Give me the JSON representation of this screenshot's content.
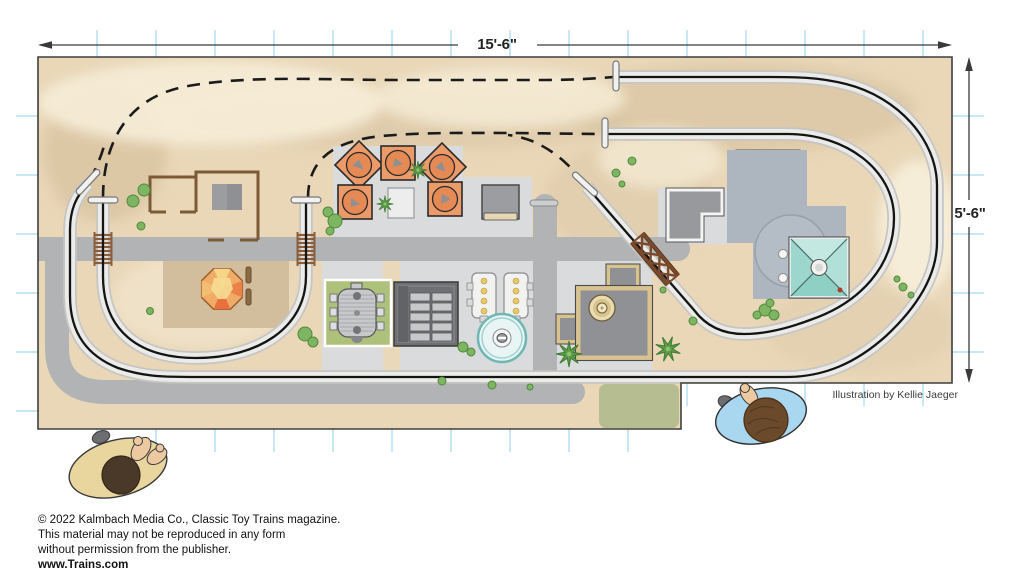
{
  "figure": {
    "title": "toy-train-layout-track-plan",
    "credit": "Illustration by Kellie Jaeger",
    "dimensions": {
      "width_label": "15'-6\"",
      "height_label": "5'-6\""
    },
    "copyright": {
      "line1": "© 2022 Kalmbach Media Co., Classic Toy Trains magazine.",
      "line2": "This material may not be reproduced in any form",
      "line3": "without permission from the publisher.",
      "line4": "www.Trains.com"
    },
    "colors": {
      "board_base": "#e9d7b8",
      "terrain_light": "#f6ecd6",
      "terrain_dark": "#d8c4a1",
      "road": "#b2b3b5",
      "plaza": "#dadbdc",
      "platform_blue_gray": "#adb6be",
      "track_rail": "#141414",
      "track_bed": "#ebebe9",
      "bridge_brown": "#7a4a2a",
      "tree_green": "#7eb563",
      "ride_orange": "#eb9a69",
      "tent_teal": "#a6dad1",
      "ride_pad_green": "#adc17b",
      "grid_tick_blue": "#bfe3f5",
      "shirt_left_figure": "#e8d69e",
      "shirt_right_figure": "#a8d7ef"
    },
    "scenery_items": [
      "station-floorplan",
      "orange-ride-cars",
      "kiosk",
      "gray-roof-building",
      "green-pad-ride",
      "window-roof-building",
      "loading-platforms",
      "round-pool-ride",
      "factory-building",
      "l-shaped-building",
      "notched-building",
      "pavilion-tent",
      "gem-canopy",
      "road-gate",
      "trestle-bridge",
      "track-bumpers",
      "overhead-route-dashed",
      "viewer-figure-left",
      "viewer-figure-right"
    ]
  }
}
